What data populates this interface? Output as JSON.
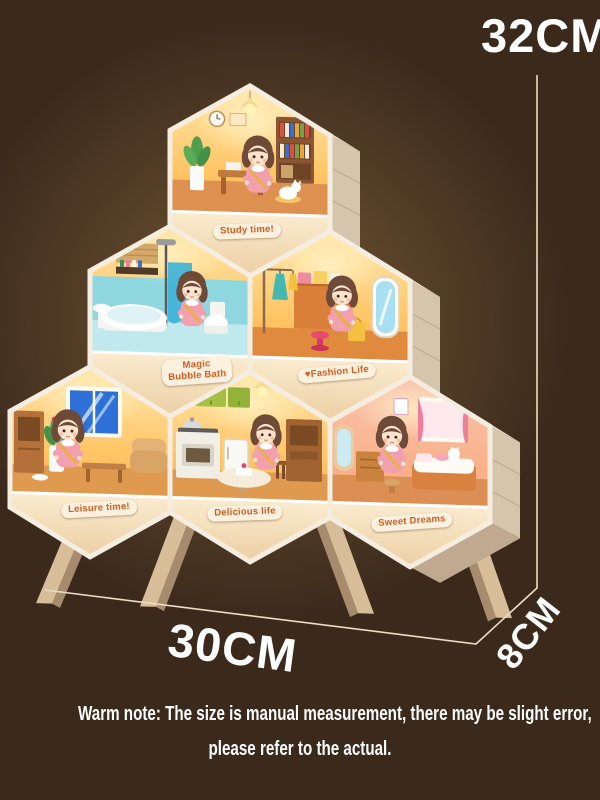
{
  "dimensions": {
    "height": "32CM",
    "width": "30CM",
    "depth": "8CM"
  },
  "rooms": [
    {
      "id": "study",
      "label": "Study time!"
    },
    {
      "id": "bath",
      "label": "Magic Bubble Bath"
    },
    {
      "id": "fashion",
      "label": "♥Fashion Life"
    },
    {
      "id": "leisure",
      "label": "Leisure time!"
    },
    {
      "id": "delicious",
      "label": "Delicious life"
    },
    {
      "id": "sweet",
      "label": "Sweet Dreams"
    }
  ],
  "note": {
    "line1": "Warm note: The size is manual measurement, there may be slight error,",
    "line2": "please refer to the actual."
  },
  "colors": {
    "bg": "#3B2A1C",
    "text": "#FFFFFF",
    "dim-line": "#EADCC4",
    "badge-bg": "#FBF1DE",
    "badge-text": "#D95B1F",
    "frame": "#F4EDE0",
    "panel": "#F5E2C2"
  }
}
